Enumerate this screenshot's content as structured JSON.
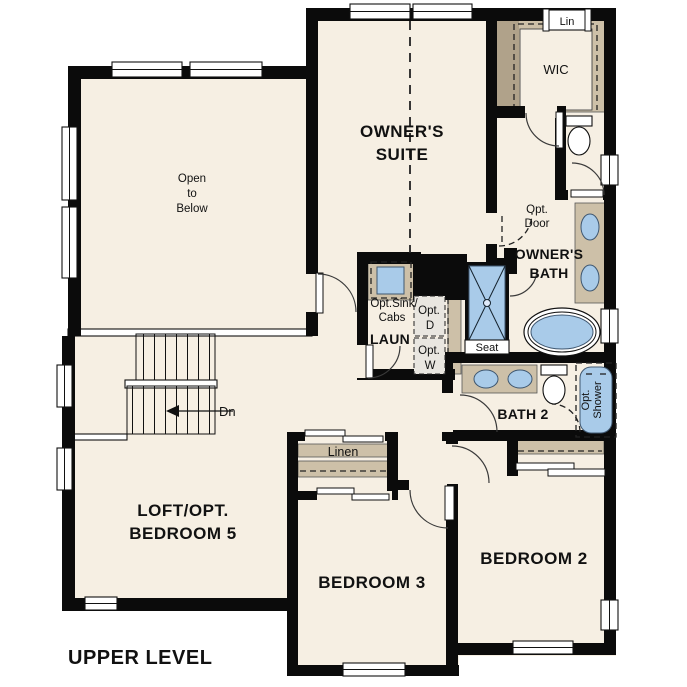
{
  "colors": {
    "floor": "#f6efe3",
    "wall": "#0b0b0b",
    "counter": "#cdc0a8",
    "counter_dark": "#b0a28a",
    "fixture_blue": "#a9cbe9",
    "fixture_edge": "#3f5770",
    "appliance_gray": "#e9e6e0",
    "line": "#555555"
  },
  "plan": {
    "title": "UPPER LEVEL"
  },
  "rooms": {
    "owners_suite": {
      "l1": "OWNER'S",
      "l2": "SUITE"
    },
    "open_to_below": {
      "l1": "Open",
      "l2": "to",
      "l3": "Below"
    },
    "loft": {
      "l1": "LOFT/OPT.",
      "l2": "BEDROOM 5"
    },
    "bedroom2": {
      "label": "BEDROOM 2"
    },
    "bedroom3": {
      "label": "BEDROOM 3"
    },
    "owners_bath": {
      "l1": "OWNER'S",
      "l2": "BATH"
    },
    "bath2": {
      "label": "BATH 2"
    },
    "laundry": {
      "label": "LAUN"
    },
    "wic": {
      "label": "WIC"
    },
    "lin": {
      "label": "Lin"
    },
    "linen": {
      "label": "Linen"
    }
  },
  "annotations": {
    "opt_door": {
      "l1": "Opt.",
      "l2": "Door"
    },
    "opt_sink": {
      "l1": "Opt.Sink/",
      "l2": "Cabs"
    },
    "opt_dryer": {
      "l1": "Opt.",
      "l2": "D"
    },
    "opt_washer": {
      "l1": "Opt.",
      "l2": "W"
    },
    "opt_shower": {
      "l1": "Opt.",
      "l2": "Shower"
    },
    "seat": "Seat",
    "stairs_down": "Dn"
  }
}
